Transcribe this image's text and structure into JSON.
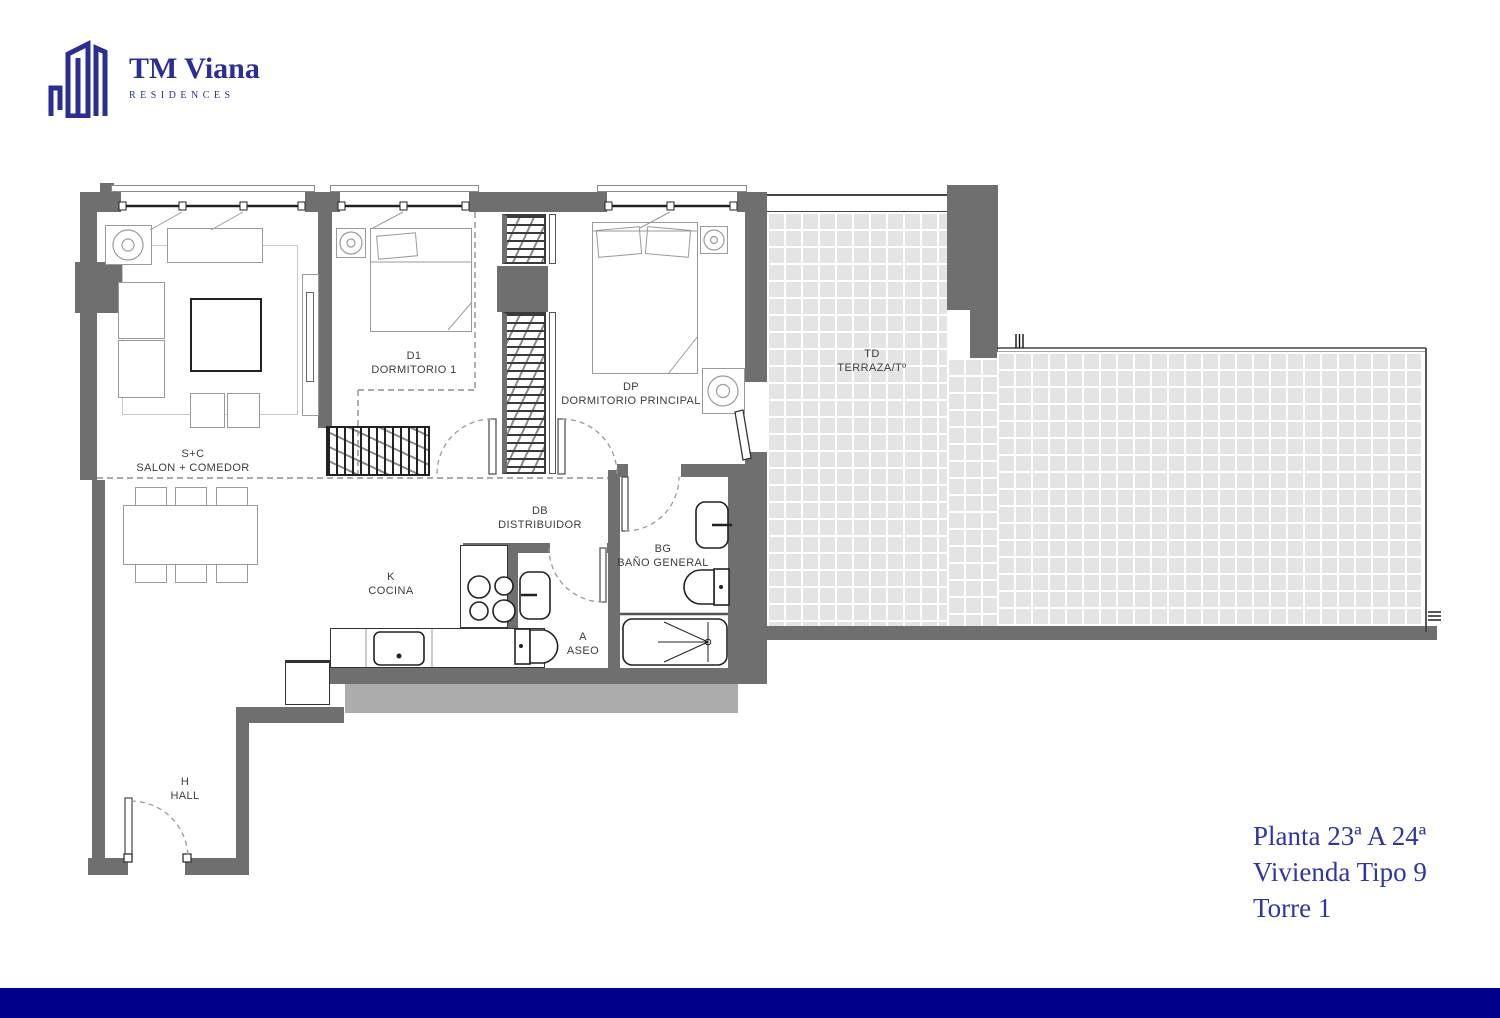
{
  "brand": {
    "name": "TM Viana",
    "tagline": "RESIDENCES"
  },
  "title_block": {
    "line1": "Planta 23ª A 24ª",
    "line2": "Vivienda Tipo 9",
    "line3": "Torre 1"
  },
  "rooms": [
    {
      "id": "salon-comedor",
      "code": "S+C",
      "name": "SALON + COMEDOR"
    },
    {
      "id": "dormitorio-1",
      "code": "D1",
      "name": "DORMITORIO 1"
    },
    {
      "id": "dormitorio-principal",
      "code": "DP",
      "name": "DORMITORIO PRINCIPAL"
    },
    {
      "id": "terraza",
      "code": "TD",
      "name": "TERRAZA/Tº"
    },
    {
      "id": "distribuidor",
      "code": "DB",
      "name": "DISTRIBUIDOR"
    },
    {
      "id": "bano-general",
      "code": "BG",
      "name": "BAÑO GENERAL"
    },
    {
      "id": "cocina",
      "code": "K",
      "name": "COCINA"
    },
    {
      "id": "aseo",
      "code": "A",
      "name": "ASEO"
    },
    {
      "id": "hall",
      "code": "H",
      "name": "HALL"
    }
  ],
  "colors": {
    "wall_gray": "#6f6f6f",
    "slab_gray": "#acacac",
    "terrace_tile": "#e4e4e4",
    "bottom_bar_navy": "#00008b",
    "brand_blue": "#2b2e92",
    "title_blue": "#2f35a3"
  }
}
